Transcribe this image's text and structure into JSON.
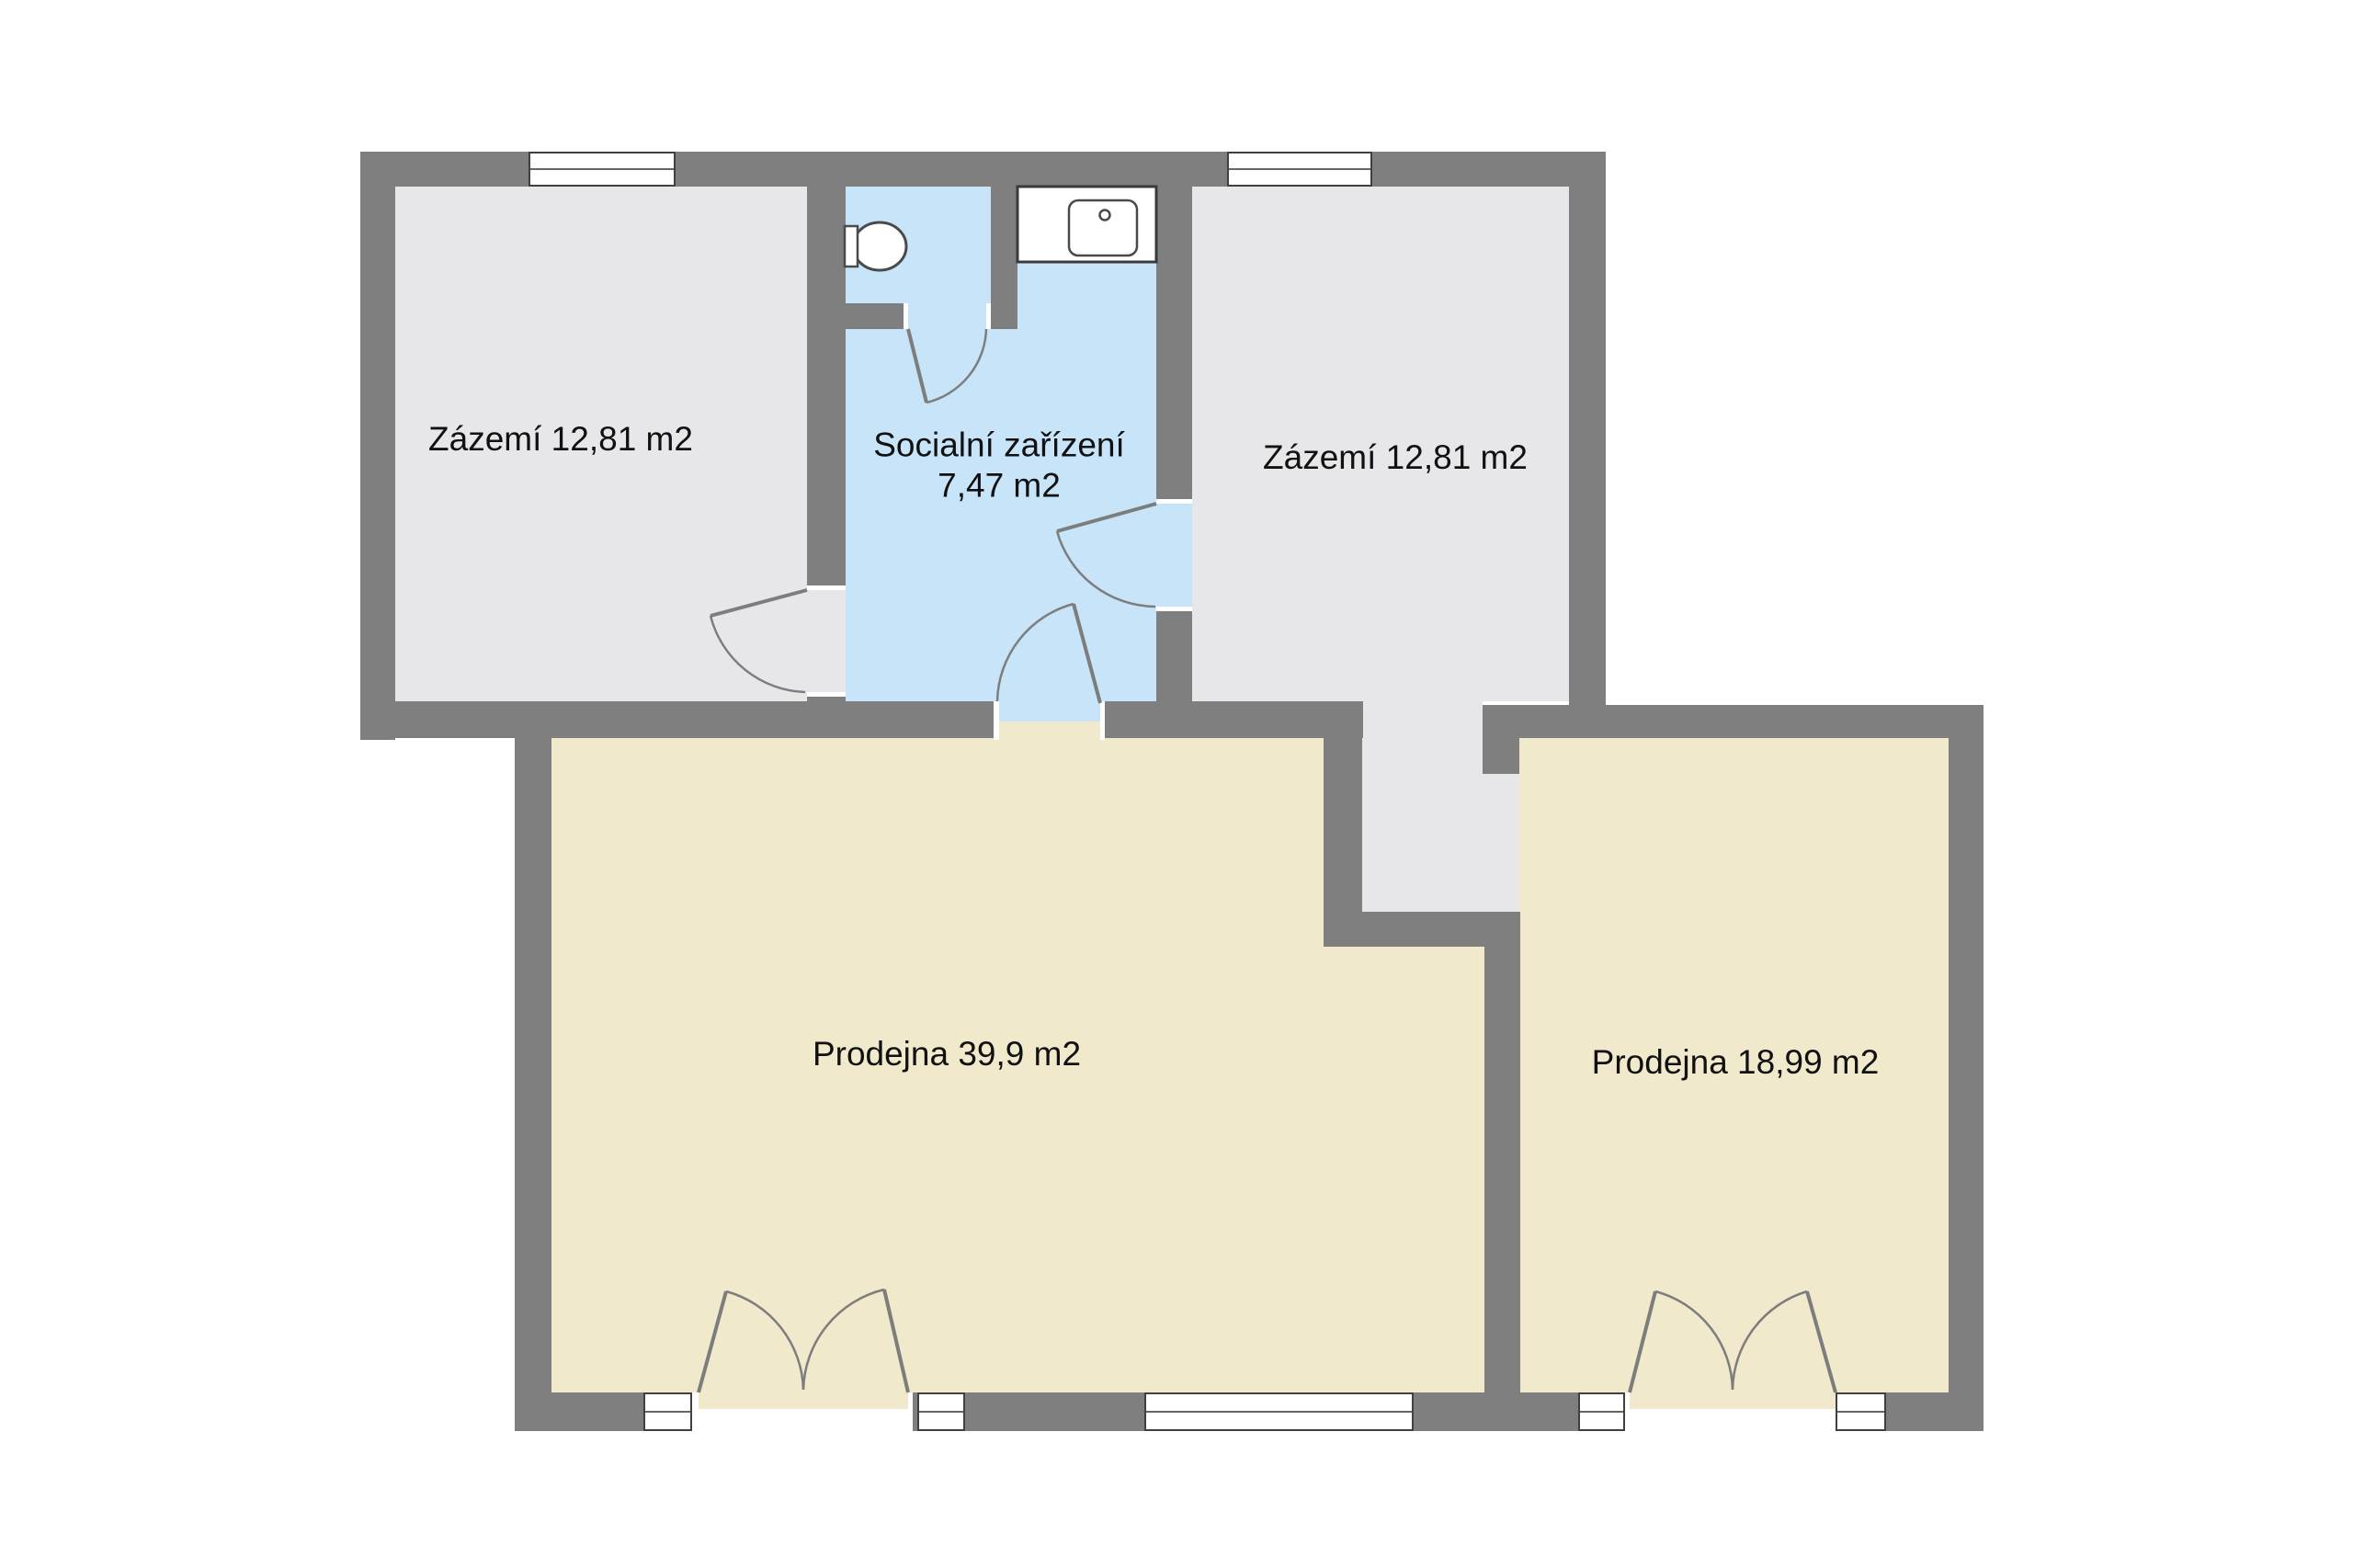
{
  "floorplan": {
    "colors": {
      "wall": "#7f7f7f",
      "floor_gray": "#e7e7e9",
      "floor_blue": "#c8e4f8",
      "floor_cream": "#f0e9cc",
      "line": "#7d7d7d",
      "text": "#111111"
    },
    "rooms": [
      {
        "name": "zazemi-left",
        "label": "Zázemí 12,81 m2"
      },
      {
        "name": "socialni-zarizeni",
        "label_line1": "Socialní zařízení",
        "label_line2": "7,47 m2"
      },
      {
        "name": "zazemi-right",
        "label": "Zázemí 12,81 m2"
      },
      {
        "name": "prodejna-large",
        "label": "Prodejna 39,9 m2"
      },
      {
        "name": "prodejna-small",
        "label": "Prodejna 18,99 m2"
      }
    ],
    "fixtures": [
      {
        "name": "toilet"
      },
      {
        "name": "sink"
      }
    ]
  }
}
